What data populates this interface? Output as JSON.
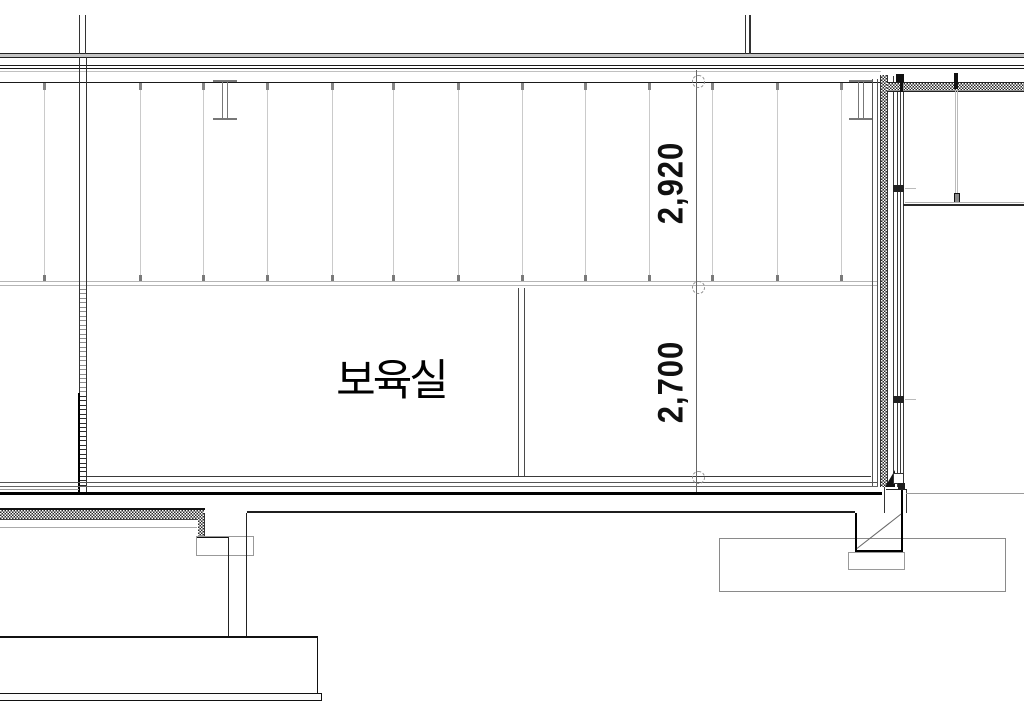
{
  "drawing_title": "architectural-section-detail",
  "room": {
    "label": "보육실"
  },
  "dimensions": {
    "upper": "2,920",
    "lower": "2,700"
  },
  "colors": {
    "line_dark": "#1a1a1a",
    "line_medium": "#555555",
    "line_gray": "#aaaaaa",
    "hanger_gray": "#cacaca",
    "slab_fill": "#c4c4c4",
    "background": "#ffffff"
  },
  "structure": {
    "hanger_xs": [
      44,
      140,
      203,
      267,
      332,
      393,
      458,
      522,
      585,
      649,
      712,
      777,
      841
    ],
    "hanger_top": 84,
    "hanger_bottom": 281,
    "rung_top": 289,
    "rung_bottom": 489,
    "rung_step": 4.45,
    "rung_dark_from": 393
  }
}
